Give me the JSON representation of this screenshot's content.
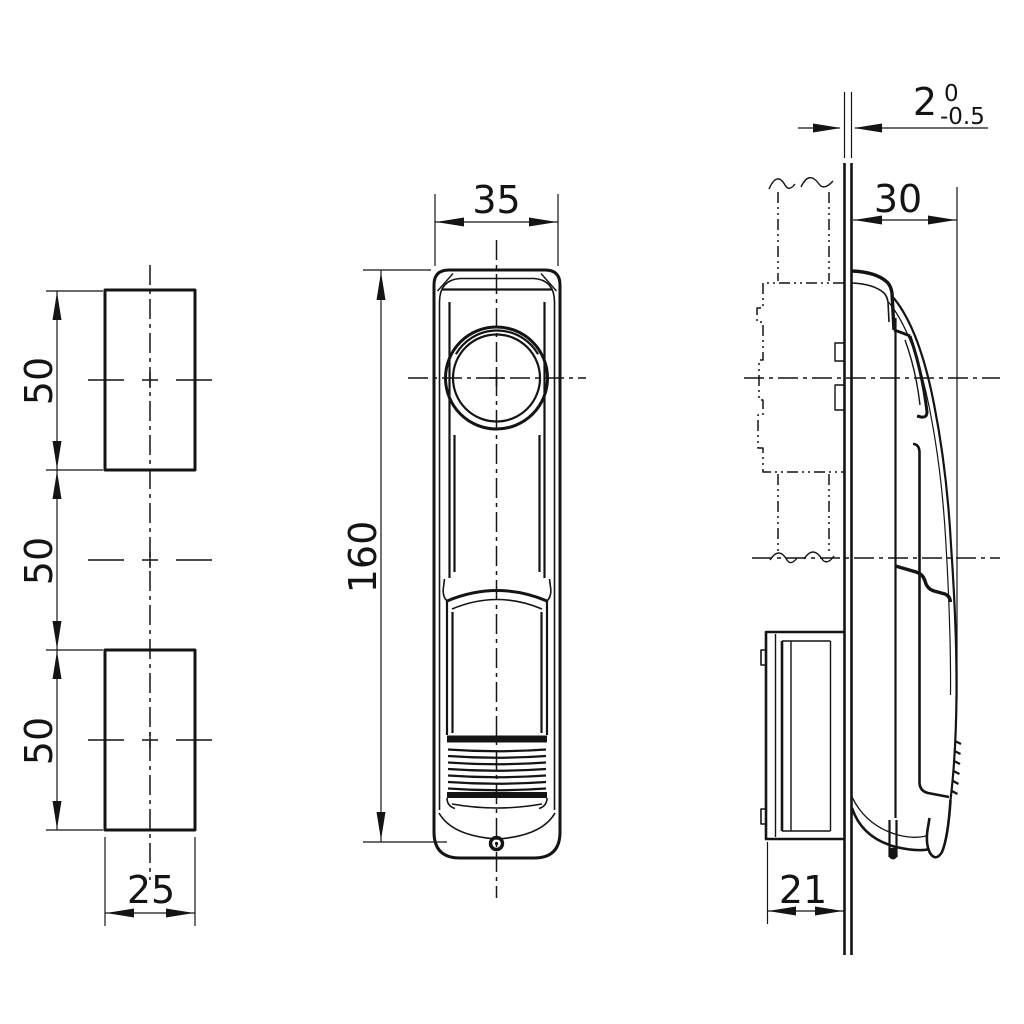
{
  "colors": {
    "line": "#141414",
    "background": "#ffffff"
  },
  "views": {
    "left_view": {
      "dimensions": {
        "cutout_height_top": "50",
        "cutout_gap_middle": "50",
        "cutout_height_bottom": "50",
        "cutout_width": "25"
      }
    },
    "front_view": {
      "dimensions": {
        "body_width": "35",
        "body_height": "160"
      }
    },
    "side_view": {
      "dimensions": {
        "panel_thickness": "2",
        "panel_thickness_tol_upper": "0",
        "panel_thickness_tol_lower": "-0.5",
        "handle_depth": "30",
        "housing_depth": "21"
      }
    }
  }
}
